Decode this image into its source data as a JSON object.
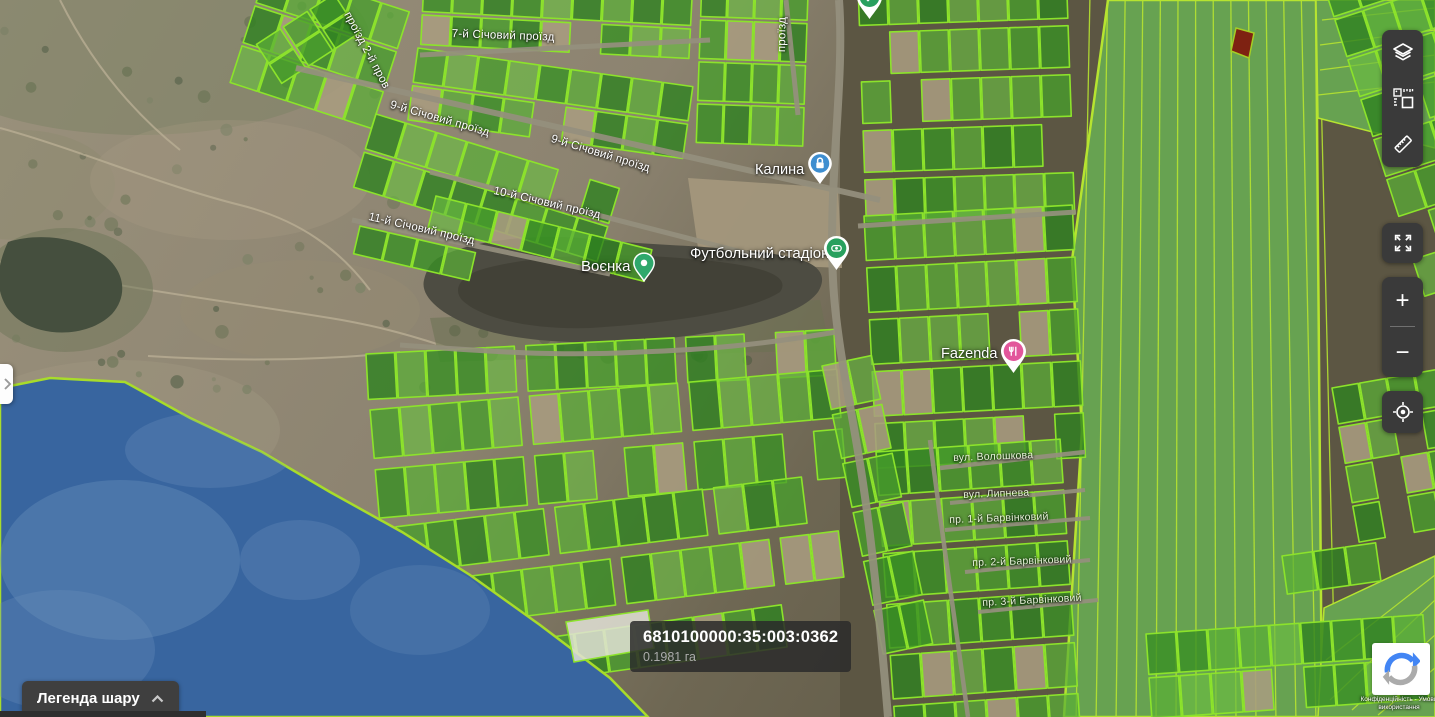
{
  "pois": [
    {
      "name": "Воєнка",
      "icon": "pin"
    },
    {
      "name": "Футбольний стадіон",
      "icon": "stadium"
    },
    {
      "name": "Калина",
      "icon": "lock"
    },
    {
      "name": "Fazenda",
      "icon": "restaurant"
    }
  ],
  "streets": [
    {
      "name": "7-й Січовий проїзд"
    },
    {
      "name": "проїзд 2-й пров"
    },
    {
      "name": "9-й Січовий проїзд"
    },
    {
      "name": "9-й Січовий проїзд"
    },
    {
      "name": "10-й Січовий проїзд"
    },
    {
      "name": "11-й Січовий проїзд"
    },
    {
      "name": "проїзд"
    },
    {
      "name": "вул. Волошкова"
    },
    {
      "name": "вул. Липнева"
    },
    {
      "name": "пр. 1-й Барвінковий"
    },
    {
      "name": "пр. 2-й Барвінковий"
    },
    {
      "name": "пр. 3-й Барвінковий"
    }
  ],
  "tooltip": {
    "parcel_id": "6810100000:35:003:0362",
    "area": "0.1981 га"
  },
  "legend": {
    "label": "Легенда шару"
  },
  "controls": {
    "zoom_in": "+",
    "zoom_out": "−"
  },
  "toolbar": {
    "icons": [
      "layers-icon",
      "measure-parcel-icon",
      "ruler-icon"
    ]
  },
  "recaptcha": {
    "terms_line1": "Конфіденційність - Умови",
    "terms_line2": "використання"
  },
  "colors": {
    "parcel_stroke": "#8CE32B",
    "field_line": "#B6E430",
    "water_overlay": "#38659F",
    "panel_bg": "#3A3A3A",
    "marker_green": "#2FA86C",
    "marker_blue": "#3E8ED0",
    "marker_pink": "#E2569B"
  }
}
